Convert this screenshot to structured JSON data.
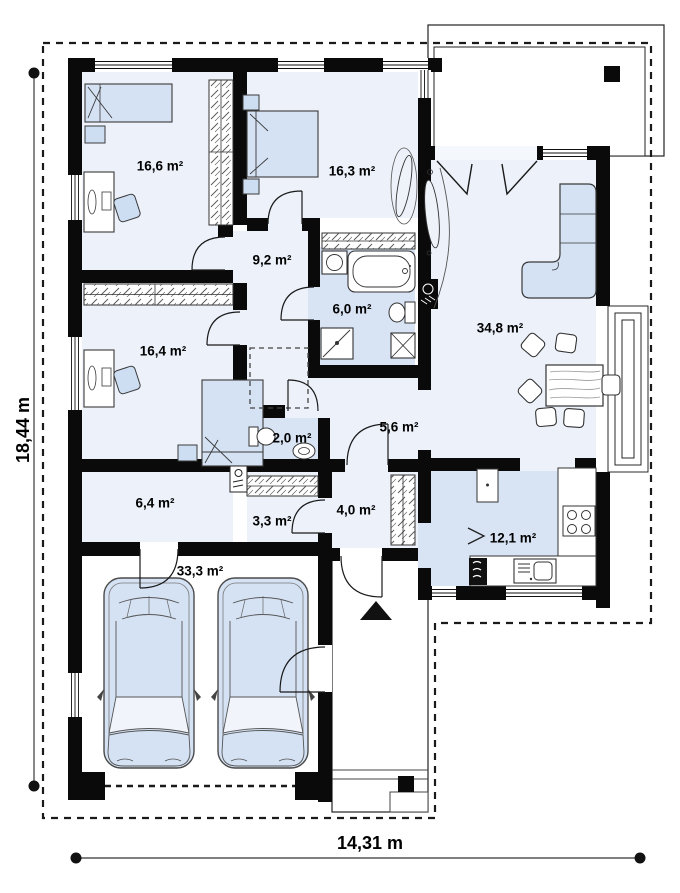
{
  "plan": {
    "dimensions": {
      "height_label": "18,44 m",
      "width_label": "14,31 m"
    },
    "rooms": [
      {
        "id": "bedroom-1",
        "area_label": "16,6 m²"
      },
      {
        "id": "bedroom-2",
        "area_label": "16,3 m²"
      },
      {
        "id": "corridor",
        "area_label": "9,2 m²"
      },
      {
        "id": "bathroom",
        "area_label": "6,0 m²"
      },
      {
        "id": "living-room",
        "area_label": "34,8 m²"
      },
      {
        "id": "bedroom-3",
        "area_label": "16,4 m²"
      },
      {
        "id": "wc",
        "area_label": "2,0 m²"
      },
      {
        "id": "hallway",
        "area_label": "5,6 m²"
      },
      {
        "id": "utility",
        "area_label": "6,4 m²"
      },
      {
        "id": "closet",
        "area_label": "3,3 m²"
      },
      {
        "id": "vestibule",
        "area_label": "4,0 m²"
      },
      {
        "id": "kitchen",
        "area_label": "12,1 m²"
      },
      {
        "id": "garage",
        "area_label": "33,3 m²"
      }
    ],
    "colors": {
      "wall": "#0a0a0a",
      "room_fill": "#ecf1fa",
      "wet_room_fill": "#d8e4f4",
      "furniture_fill": "#d5e2f4",
      "outline": "#2a2a2a"
    }
  }
}
